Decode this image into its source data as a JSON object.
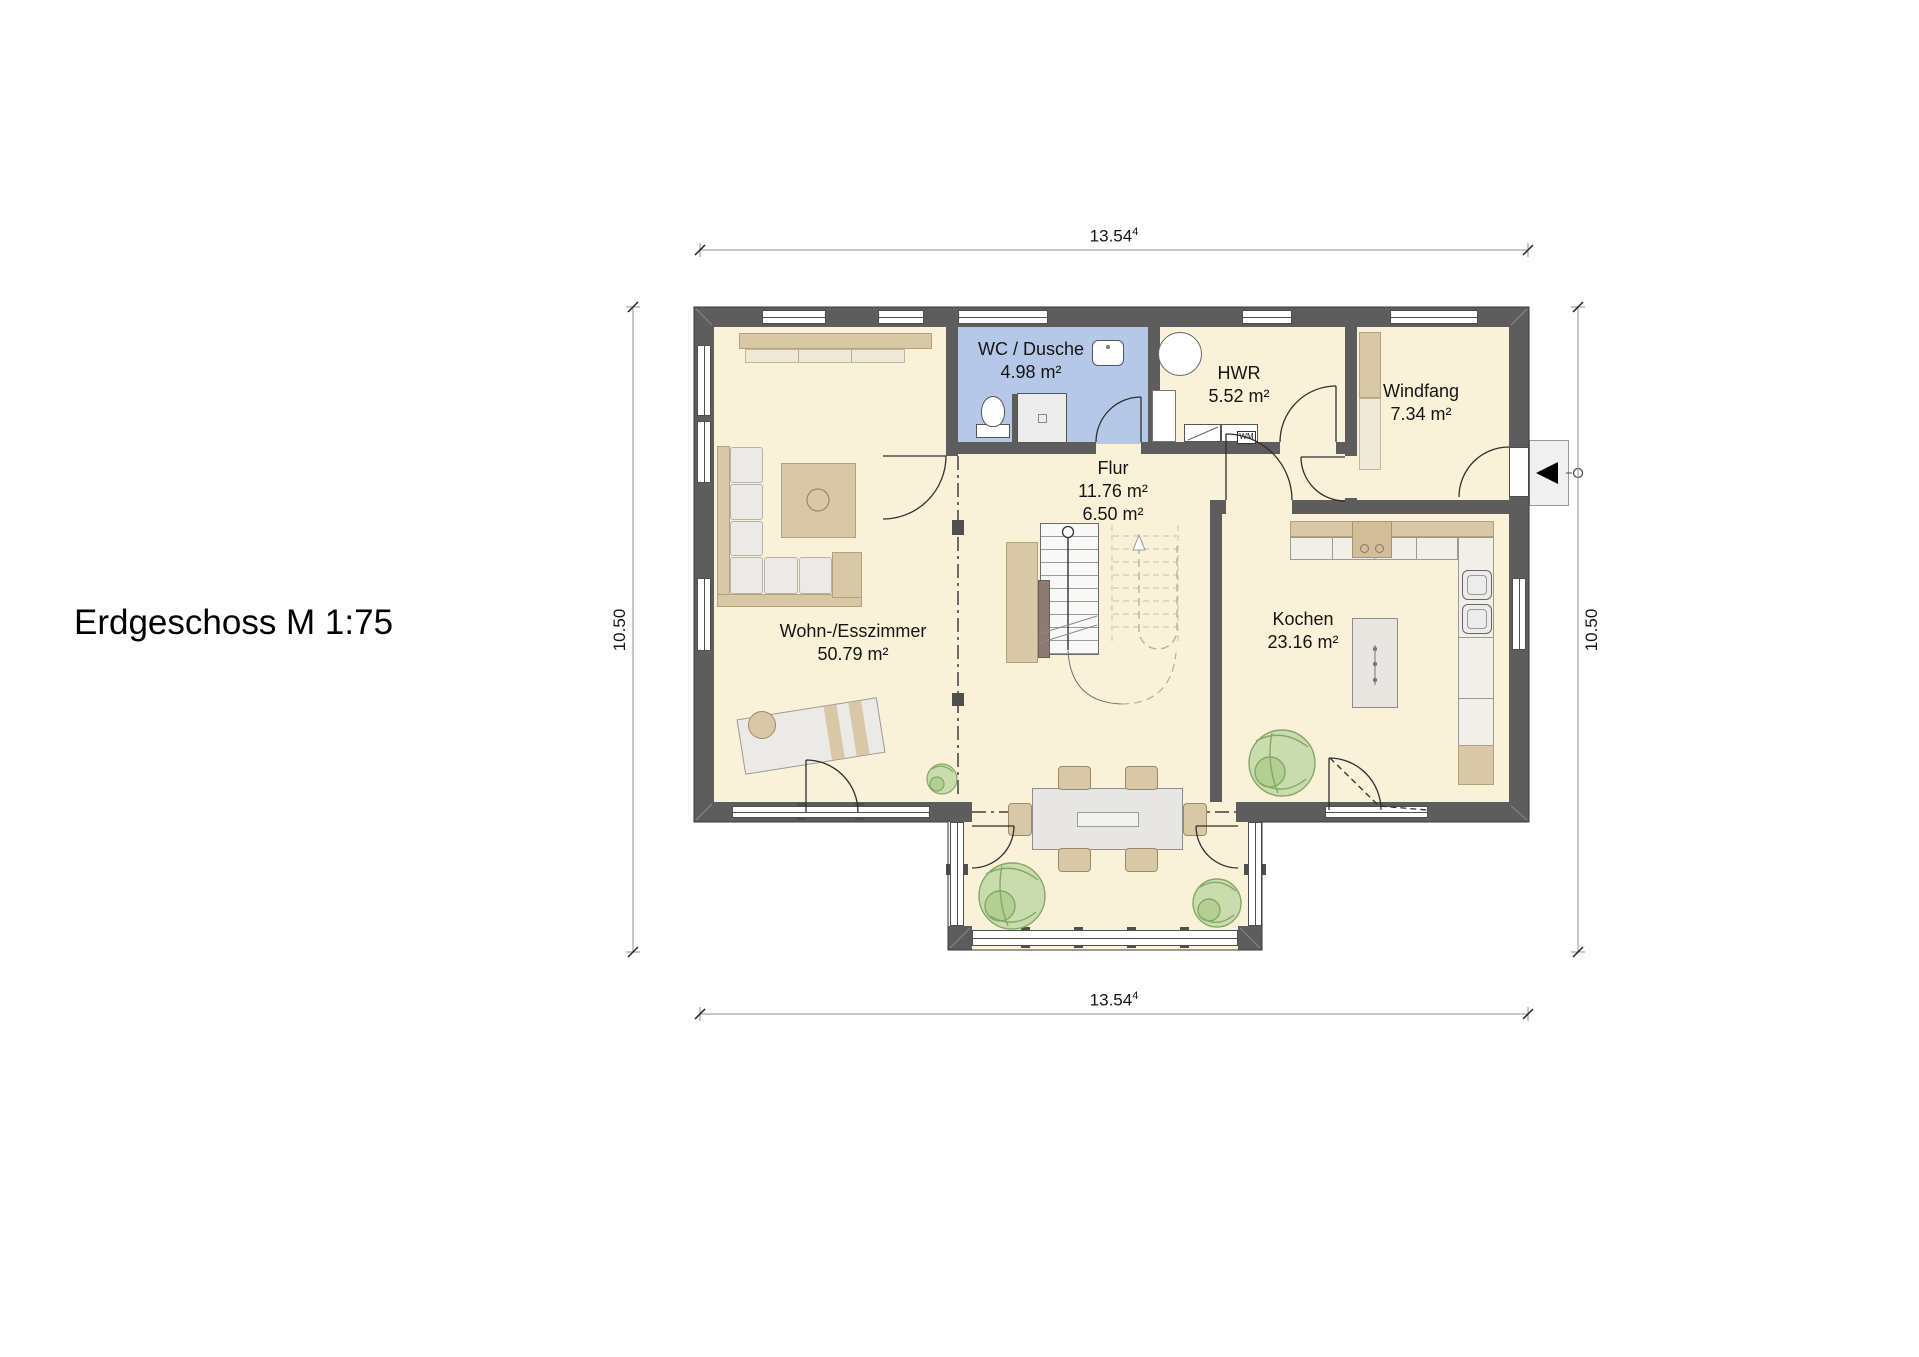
{
  "title": "Erdgeschoss M 1:75",
  "dimensions": {
    "top": {
      "value": "13.54",
      "sup": "4"
    },
    "bottom": {
      "value": "13.54",
      "sup": "4"
    },
    "left": "10.50",
    "right": "10.50"
  },
  "rooms": {
    "living": {
      "name": "Wohn-/Esszimmer",
      "area": "50.79 m²"
    },
    "wc": {
      "name": "WC / Dusche",
      "area": "4.98 m²"
    },
    "hwr": {
      "name": "HWR",
      "area": "5.52 m²"
    },
    "windfang": {
      "name": "Windfang",
      "area": "7.34 m²"
    },
    "flur": {
      "name": "Flur",
      "area_total": "11.76 m²",
      "area_open": "6.50 m²"
    },
    "kitchen": {
      "name": "Kochen",
      "area": "23.16 m²"
    }
  },
  "labels": {
    "washing_machine": "WM"
  },
  "colors": {
    "wall": "#5d5d5d",
    "floor": "#faf2d8",
    "wet_room_floor": "#b6c8e8",
    "furniture_tan": "#d9c8a6",
    "plant_green": "#c9dcae"
  }
}
